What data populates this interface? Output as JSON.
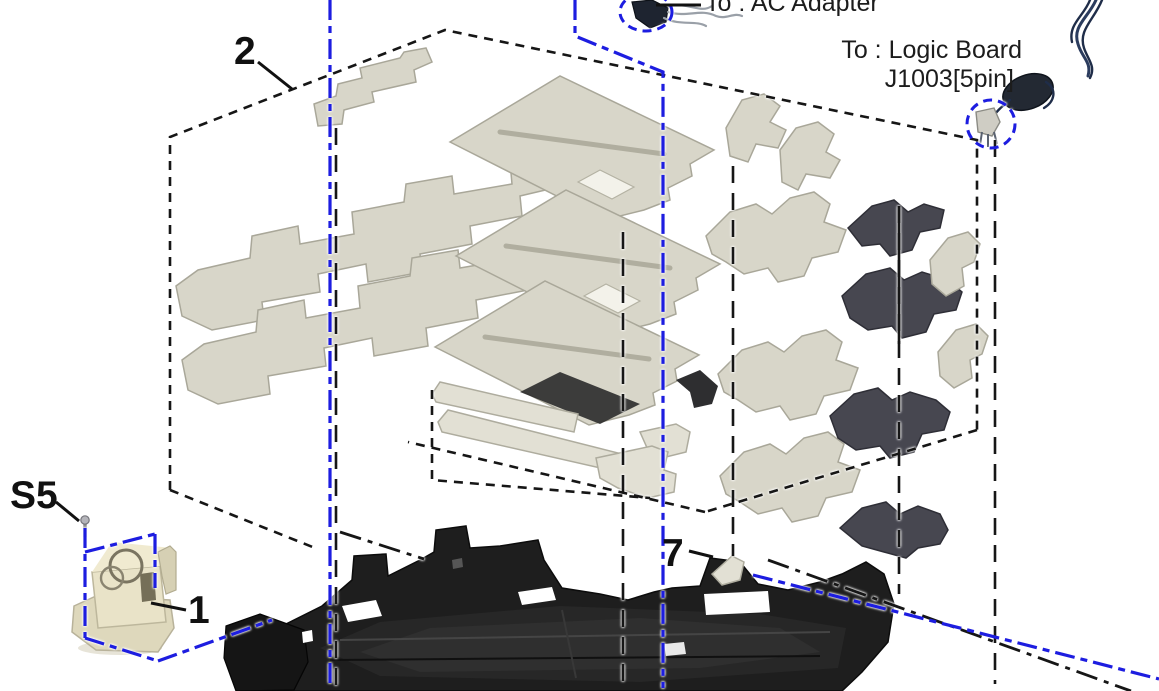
{
  "page": {
    "width": 1159,
    "height": 691,
    "background": "#ffffff"
  },
  "figure": {
    "type": "exploded-view-diagram",
    "description": "Service-manual exploded view: bottom case chassis with insulation foam sheets, power entry module and cable routing",
    "callouts": {
      "part2": "2",
      "screw": "S5",
      "part1": "1",
      "part7": "7"
    },
    "annotations": {
      "ac_adapter": "To : AC Adapter",
      "logic_board_line1": "To : Logic Board",
      "logic_board_line2": "J1003[5pin]"
    },
    "icons": {
      "ac_connector": "ac-adapter-connector-icon",
      "logic_connector": "logic-board-connector-icon",
      "ferrite": "ferrite-bead-icon",
      "screw": "screw-icon"
    },
    "colors": {
      "routing_blue": "#1d1de0",
      "outline_black": "#161616",
      "foam_light": "#d8d6c9",
      "foam_dark": "#474750",
      "chassis_dark": "#1e1e1e",
      "module_cream": "#e9e3c8",
      "cable_navy": "#2b3c5e"
    }
  }
}
